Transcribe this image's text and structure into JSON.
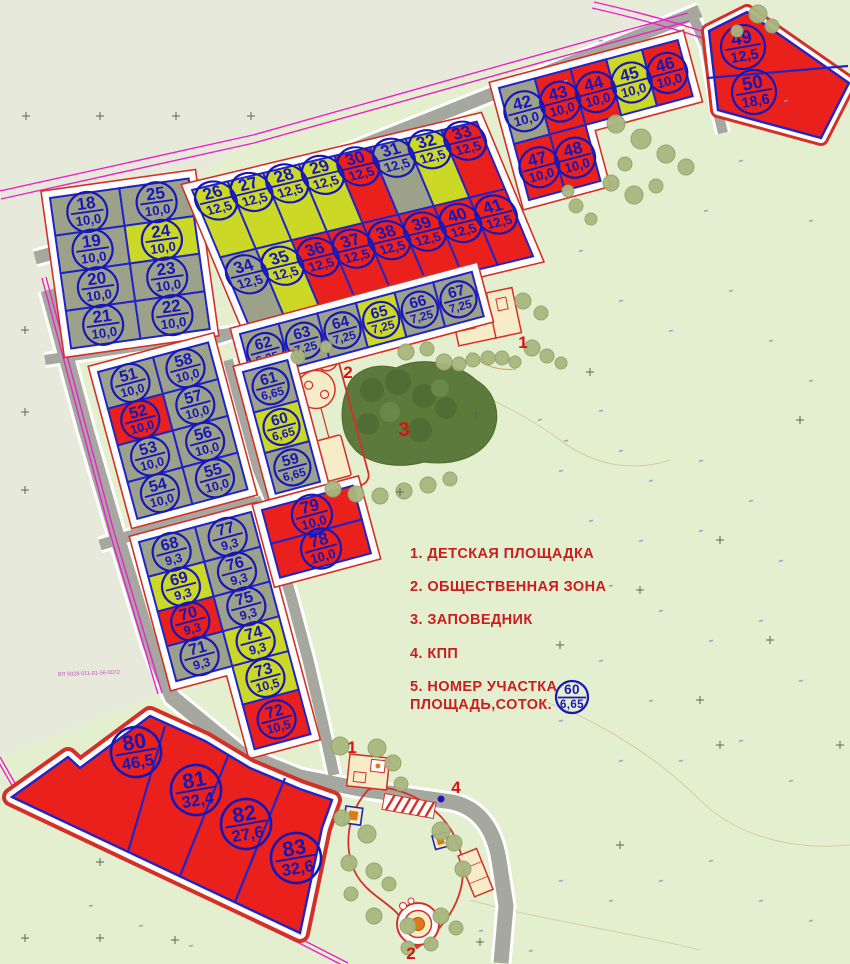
{
  "legend": {
    "items": [
      {
        "text": "1. ДЕТСКАЯ ПЛОЩАДКА"
      },
      {
        "text": "2. ОБЩЕСТВЕННАЯ ЗОНА"
      },
      {
        "text": "3. ЗАПОВЕДНИК"
      },
      {
        "text": "4. КПП"
      },
      {
        "text": "5. НОМЕР УЧАСТКА",
        "text2": "ПЛОЩАДЬ,СОТОК."
      }
    ],
    "sample": {
      "number": "60",
      "area": "6,65"
    }
  },
  "map_note": "ВП 5028-011-01-56-0072",
  "colors": {
    "sold": "#e9201c",
    "reserved": "#ccd826",
    "free": "#9ca189",
    "label_blue": "#1717b8",
    "plot_border": "#2024c8",
    "block_border": "#d43028",
    "marker_red": "#dd1111",
    "legend_red": "#c81e1e",
    "road": "#a6a89f",
    "boundary_magenta": "#e822cc",
    "reserve_green": "#5c7a3b",
    "tree": "#a9b77f",
    "building_beige": "#f6ecc8",
    "orange": "#e07818"
  },
  "markers": [
    {
      "text": "1",
      "x": 523,
      "y": 348
    },
    {
      "text": "2",
      "x": 348,
      "y": 378
    },
    {
      "text": "3",
      "x": 404,
      "y": 436
    },
    {
      "text": "1",
      "x": 352,
      "y": 753
    },
    {
      "text": "4",
      "x": 456,
      "y": 793
    },
    {
      "text": "2",
      "x": 411,
      "y": 959
    }
  ],
  "plots": [
    {
      "n": 18,
      "a": "10,0",
      "s": "free"
    },
    {
      "n": 19,
      "a": "10,0",
      "s": "free"
    },
    {
      "n": 20,
      "a": "10,0",
      "s": "free"
    },
    {
      "n": 21,
      "a": "10,0",
      "s": "free"
    },
    {
      "n": 22,
      "a": "10,0",
      "s": "free"
    },
    {
      "n": 23,
      "a": "10,0",
      "s": "free"
    },
    {
      "n": 24,
      "a": "10,0",
      "s": "reserved"
    },
    {
      "n": 25,
      "a": "10,0",
      "s": "free"
    },
    {
      "n": 26,
      "a": "12,5",
      "s": "reserved"
    },
    {
      "n": 27,
      "a": "12,5",
      "s": "reserved"
    },
    {
      "n": 28,
      "a": "12,5",
      "s": "reserved"
    },
    {
      "n": 29,
      "a": "12,5",
      "s": "reserved"
    },
    {
      "n": 30,
      "a": "12,5",
      "s": "sold"
    },
    {
      "n": 31,
      "a": "12,5",
      "s": "free"
    },
    {
      "n": 32,
      "a": "12,5",
      "s": "reserved"
    },
    {
      "n": 33,
      "a": "12,5",
      "s": "sold"
    },
    {
      "n": 34,
      "a": "12,5",
      "s": "free"
    },
    {
      "n": 35,
      "a": "12,5",
      "s": "reserved"
    },
    {
      "n": 36,
      "a": "12,5",
      "s": "sold"
    },
    {
      "n": 37,
      "a": "12,5",
      "s": "sold"
    },
    {
      "n": 38,
      "a": "12,5",
      "s": "sold"
    },
    {
      "n": 39,
      "a": "12,5",
      "s": "sold"
    },
    {
      "n": 40,
      "a": "12,5",
      "s": "sold"
    },
    {
      "n": 41,
      "a": "12,5",
      "s": "sold"
    },
    {
      "n": 42,
      "a": "10,0",
      "s": "free"
    },
    {
      "n": 43,
      "a": "10,0",
      "s": "sold"
    },
    {
      "n": 44,
      "a": "10,0",
      "s": "sold"
    },
    {
      "n": 45,
      "a": "10,0",
      "s": "reserved"
    },
    {
      "n": 46,
      "a": "10,0",
      "s": "sold"
    },
    {
      "n": 47,
      "a": "10,0",
      "s": "sold"
    },
    {
      "n": 48,
      "a": "10,0",
      "s": "sold"
    },
    {
      "n": 49,
      "a": "12,5",
      "s": "sold"
    },
    {
      "n": 50,
      "a": "18,6",
      "s": "sold"
    },
    {
      "n": 51,
      "a": "10,0",
      "s": "free"
    },
    {
      "n": 52,
      "a": "10,0",
      "s": "sold"
    },
    {
      "n": 53,
      "a": "10,0",
      "s": "free"
    },
    {
      "n": 54,
      "a": "10,0",
      "s": "free"
    },
    {
      "n": 55,
      "a": "10,0",
      "s": "free"
    },
    {
      "n": 56,
      "a": "10,0",
      "s": "free"
    },
    {
      "n": 57,
      "a": "10,0",
      "s": "free"
    },
    {
      "n": 58,
      "a": "10,0",
      "s": "free"
    },
    {
      "n": 59,
      "a": "6,65",
      "s": "free"
    },
    {
      "n": 60,
      "a": "6,65",
      "s": "reserved"
    },
    {
      "n": 61,
      "a": "6,65",
      "s": "free"
    },
    {
      "n": 62,
      "a": "6,25",
      "s": "free"
    },
    {
      "n": 63,
      "a": "7,25",
      "s": "free"
    },
    {
      "n": 64,
      "a": "7,25",
      "s": "free"
    },
    {
      "n": 65,
      "a": "7,25",
      "s": "reserved"
    },
    {
      "n": 66,
      "a": "7,25",
      "s": "free"
    },
    {
      "n": 67,
      "a": "7,25",
      "s": "free"
    },
    {
      "n": 68,
      "a": "9,3",
      "s": "free"
    },
    {
      "n": 69,
      "a": "9,3",
      "s": "reserved"
    },
    {
      "n": 70,
      "a": "9,3",
      "s": "sold"
    },
    {
      "n": 71,
      "a": "9,3",
      "s": "free"
    },
    {
      "n": 72,
      "a": "10,5",
      "s": "sold"
    },
    {
      "n": 73,
      "a": "10,5",
      "s": "reserved"
    },
    {
      "n": 74,
      "a": "9,3",
      "s": "reserved"
    },
    {
      "n": 75,
      "a": "9,3",
      "s": "free"
    },
    {
      "n": 76,
      "a": "9,3",
      "s": "free"
    },
    {
      "n": 77,
      "a": "9,3",
      "s": "free"
    },
    {
      "n": 78,
      "a": "10,0",
      "s": "sold"
    },
    {
      "n": 79,
      "a": "10,0",
      "s": "sold"
    },
    {
      "n": 80,
      "a": "46,5",
      "s": "sold"
    },
    {
      "n": 81,
      "a": "32,4",
      "s": "sold"
    },
    {
      "n": 82,
      "a": "27,6",
      "s": "sold"
    },
    {
      "n": 83,
      "a": "32,6",
      "s": "sold"
    }
  ]
}
